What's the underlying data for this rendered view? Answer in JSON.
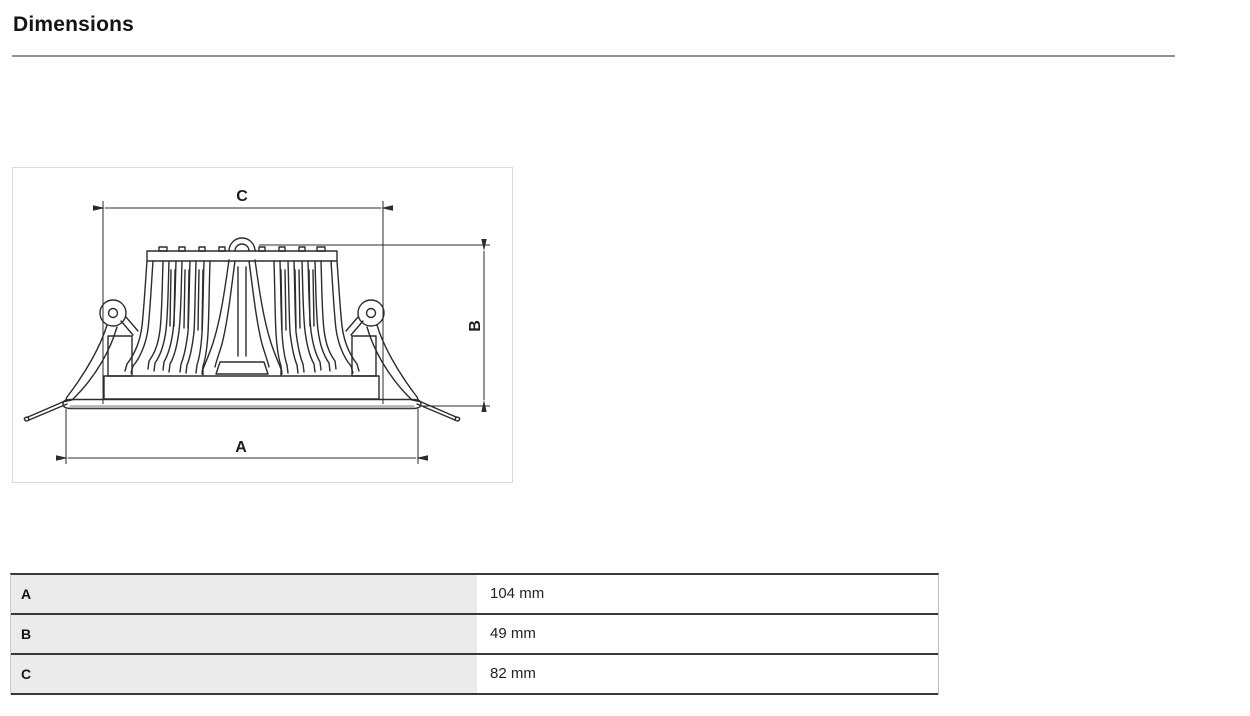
{
  "page": {
    "title": "Dimensions"
  },
  "diagram": {
    "description": "recessed-downlight-side-view",
    "dim_a": "A",
    "dim_b": "B",
    "dim_c": "C"
  },
  "table": {
    "rows": [
      {
        "label": "A",
        "value": "104 mm"
      },
      {
        "label": "B",
        "value": "49 mm"
      },
      {
        "label": "C",
        "value": "82 mm"
      }
    ]
  },
  "colors": {
    "line_work": "#2b2b2b",
    "table_border": "#383838",
    "label_cell_bg": "#ebebeb",
    "title_rule": "#8f8f8f",
    "box_border": "#dadada",
    "flange_shade": "#b5b5b5"
  }
}
